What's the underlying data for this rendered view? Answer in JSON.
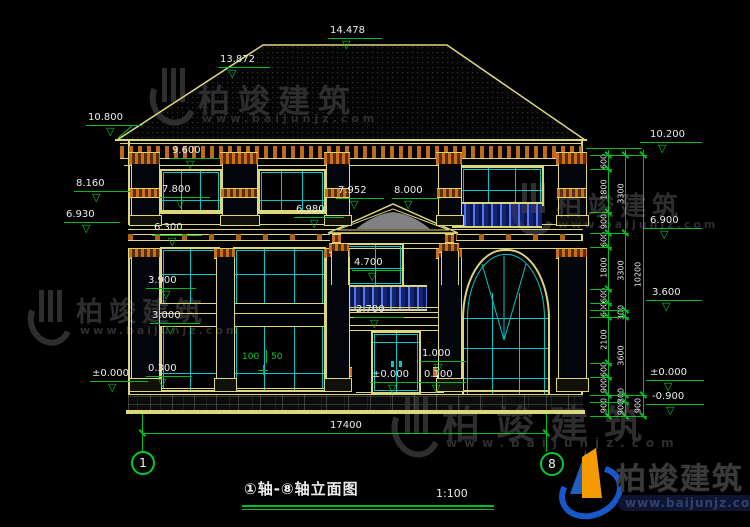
{
  "icons": {
    "elevation_triangle": "▽"
  },
  "watermark": {
    "brand": "柏竣建筑",
    "site": "www.baijunjz.com"
  },
  "title_block": {
    "title": "①轴-⑧轴立面图",
    "scale": "1:100"
  },
  "axes": {
    "left": "1",
    "right": "8"
  },
  "dims": {
    "total_width": "17400",
    "gap_a": "100",
    "gap_b": "50",
    "v_top": "100",
    "v_mid": "700",
    "v_bot": "100"
  },
  "levels": {
    "roof_ridge": "14.478",
    "roof_hip": "13.872",
    "eave_left": "10.800",
    "right_top": "10.200",
    "win2_top": "9.600",
    "left_cap": "8.160",
    "portico_apex_left": "7.952",
    "portico_apex": "8.000",
    "win2_sill": "7.800",
    "portico_band": "6.980",
    "band_left": "6.930",
    "right_mid": "6.900",
    "band_bottom": "6.300",
    "balcony_top": "4.700",
    "left_lintel": "3.900",
    "right_floor": "3.600",
    "left_sill": "3.000",
    "porch_beam": "2.700",
    "pier_cap": "1.000",
    "platform": "0.300",
    "step": "0.100",
    "zero_left": "±0.000",
    "zero_center": "±0.000",
    "zero_right": "±0.000",
    "ground": "-0.900"
  },
  "chain": {
    "col1": [
      "600",
      "1800",
      "900",
      "600",
      "1800",
      "600",
      "600",
      "2100",
      "600",
      "900",
      "900"
    ],
    "col2": [
      "3300",
      "3300",
      "300",
      "3600",
      "300",
      "900"
    ],
    "col3": [
      "10200",
      "900"
    ]
  }
}
